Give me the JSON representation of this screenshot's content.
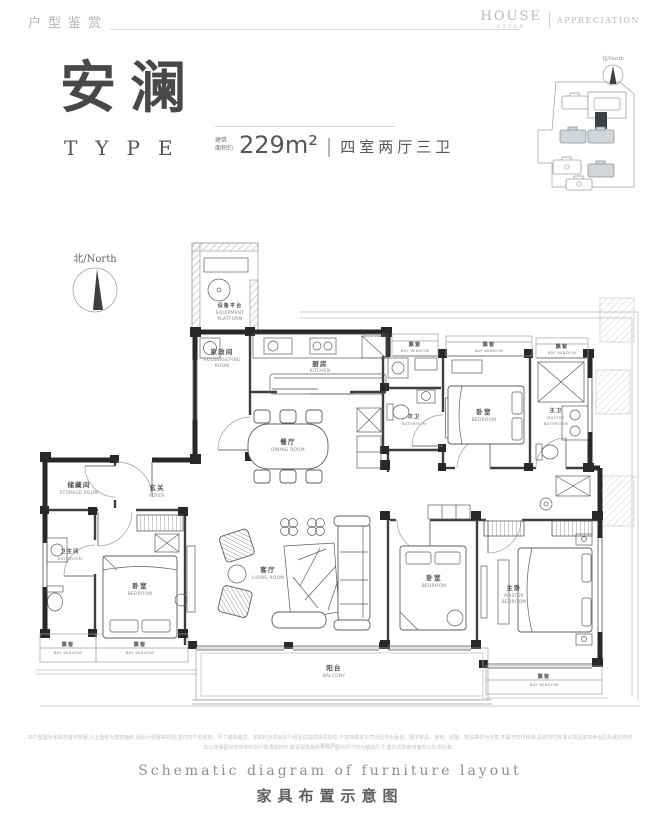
{
  "header": {
    "left_title": "户型鉴赏",
    "brand_word": "HOUSE",
    "brand_sub": "STYLE",
    "brand_word2": "APPRECIATION"
  },
  "title_block": {
    "name": "安澜",
    "type_label": "TYPE",
    "area_prefix_l1": "建筑",
    "area_prefix_l2": "面积约",
    "area_value": "229m²",
    "divider": "|",
    "spec": "四室两厅三卫"
  },
  "compass": {
    "label": "北/North"
  },
  "site_plan": {
    "compass_label": "北/North"
  },
  "plan_labels": {
    "equipment_platform": {
      "zh": "设备平台",
      "en1": "EQUIPMENT",
      "en2": "PLATFORM"
    },
    "housekeeping_room": {
      "zh": "家政间",
      "en1": "HOUSEKEEPING",
      "en2": "ROOM"
    },
    "kitchen": {
      "zh": "厨房",
      "en": "KITCHEN"
    },
    "dining_room": {
      "zh": "餐厅",
      "en": "DINING ROOM"
    },
    "foyer": {
      "zh": "玄关",
      "en": "FOYER"
    },
    "storage_room": {
      "zh": "储藏间",
      "en": "STORAGE ROOM"
    },
    "bathroom": {
      "zh": "卫生间",
      "en": "BATHROOM"
    },
    "guest_bathroom": {
      "zh": "次卫",
      "en": "BATHROOM"
    },
    "master_bathroom": {
      "zh": "主卫",
      "en1": "MASTER",
      "en2": "BATHROOM"
    },
    "bedroom": {
      "zh": "卧室",
      "en": "BEDROOM"
    },
    "master_bedroom": {
      "zh": "主卧",
      "en1": "MASTER",
      "en2": "BEDROOM"
    },
    "living_room": {
      "zh": "客厅",
      "en": "LIVING ROOM"
    },
    "balcony": {
      "zh": "阳台",
      "en": "BALCONY"
    },
    "bay_window": {
      "zh": "飘窗",
      "en": "BAY WINDOW"
    }
  },
  "footer": {
    "disclaimer_line1": "本户型图为家具布置示意图,以上面积为建筑面积,因设计调整等原因,交付时户型结构、尺寸或有差异。本资料对项目的介绍旨在提供相关信息,不意味着本公司对此作出承诺。图中家具、家电、绿植、饰品等仅为示意,不属于交付标准,具体交付标准以商品房买卖合同及其附件约定为准。",
    "disclaimer_line2": "本公司保留对宣传资料进行修改的权利,敬请留意最新资料。图中尺寸均为轴线尺寸,套内实际使用面积以实测为准。",
    "caption_en": "Schematic diagram of furniture layout",
    "caption_zh": "家具布置示意图"
  },
  "colors": {
    "wall": "#26282b",
    "line_light": "#9aa0a4",
    "title": "#48484b",
    "muted": "#b4b4b6"
  }
}
